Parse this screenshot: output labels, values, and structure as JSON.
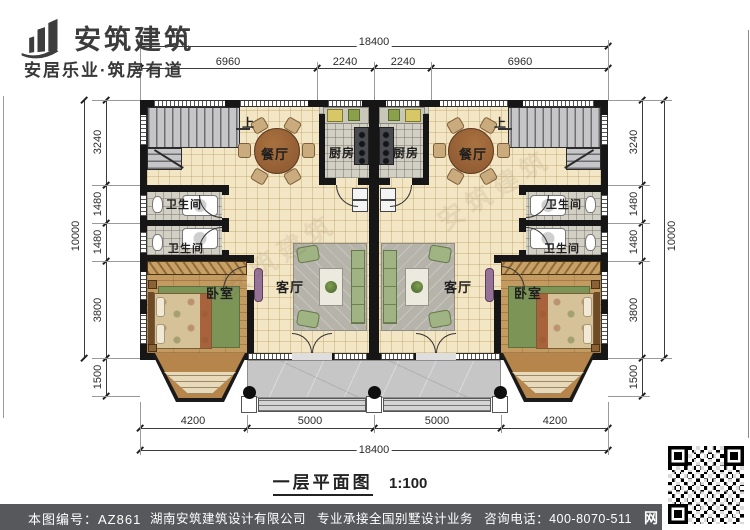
{
  "brand": {
    "name": "安筑建筑",
    "tagline": "安居乐业·筑房有道"
  },
  "drawing": {
    "title": "一层平面图",
    "scale": "1:100",
    "up_label": "上"
  },
  "rooms": {
    "dining": "餐厅",
    "kitchen": "厨房",
    "bathroom": "卫生间",
    "bedroom": "卧室",
    "living": "客厅"
  },
  "dimensions": {
    "top": {
      "overall": "18400",
      "segments": [
        "6960",
        "2240",
        "2240",
        "6960"
      ]
    },
    "bottom": {
      "overall": "18400",
      "segments": [
        "4200",
        "5000",
        "5000",
        "4200"
      ]
    },
    "left": {
      "overall": "10000",
      "segments": [
        "3240",
        "1480",
        "1480",
        "3800",
        "1500"
      ]
    },
    "right": {
      "overall": "10000",
      "segments": [
        "3240",
        "1480",
        "1480",
        "3800",
        "1500"
      ]
    }
  },
  "footer": {
    "sheet_number": "本图编号：AZ861",
    "company": "湖南安筑建筑设计有限公司",
    "service": "专业承接全国别墅设计业务",
    "phone": "咨询电话：400-8070-511",
    "web_char": "网"
  },
  "colors": {
    "wall": "#161616",
    "floor_cream": "#f3e6c4",
    "floor_gray": "#d2cfc4",
    "wood_floor": "#c39a60",
    "bay_wood": "#b5854b",
    "footer_bar": "#57585c"
  }
}
